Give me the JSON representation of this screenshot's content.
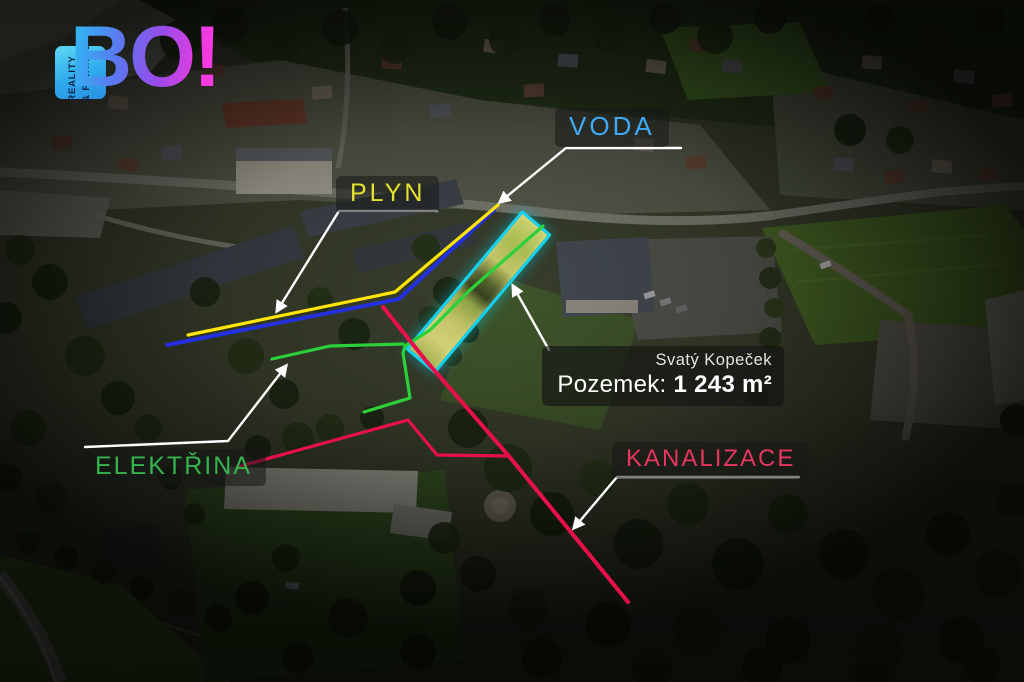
{
  "logo": {
    "wordmark": "BO!",
    "tagline_line1": "REALITY",
    "tagline_line2": "& FINANCE"
  },
  "labels": {
    "voda": "VODA",
    "plyn": "PLYN",
    "elektrina": "ELEKTŘINA",
    "kanalizace": "KANALIZACE"
  },
  "info_box": {
    "location": "Svatý Kopeček",
    "area_label": "Pozemek:",
    "area_value": "1 243 m²"
  },
  "colors": {
    "voda_label": "#3fa9f5",
    "plyn_label": "#e3e32e",
    "elektrina_label": "#35b44e",
    "kanalizace_label": "#e8355e",
    "voda_line": "#2330dd",
    "plyn_line": "#ffe608",
    "elektrina_line": "#2bd139",
    "kanalizace_line": "#e81048",
    "plot_outline": "#14d3f0"
  }
}
